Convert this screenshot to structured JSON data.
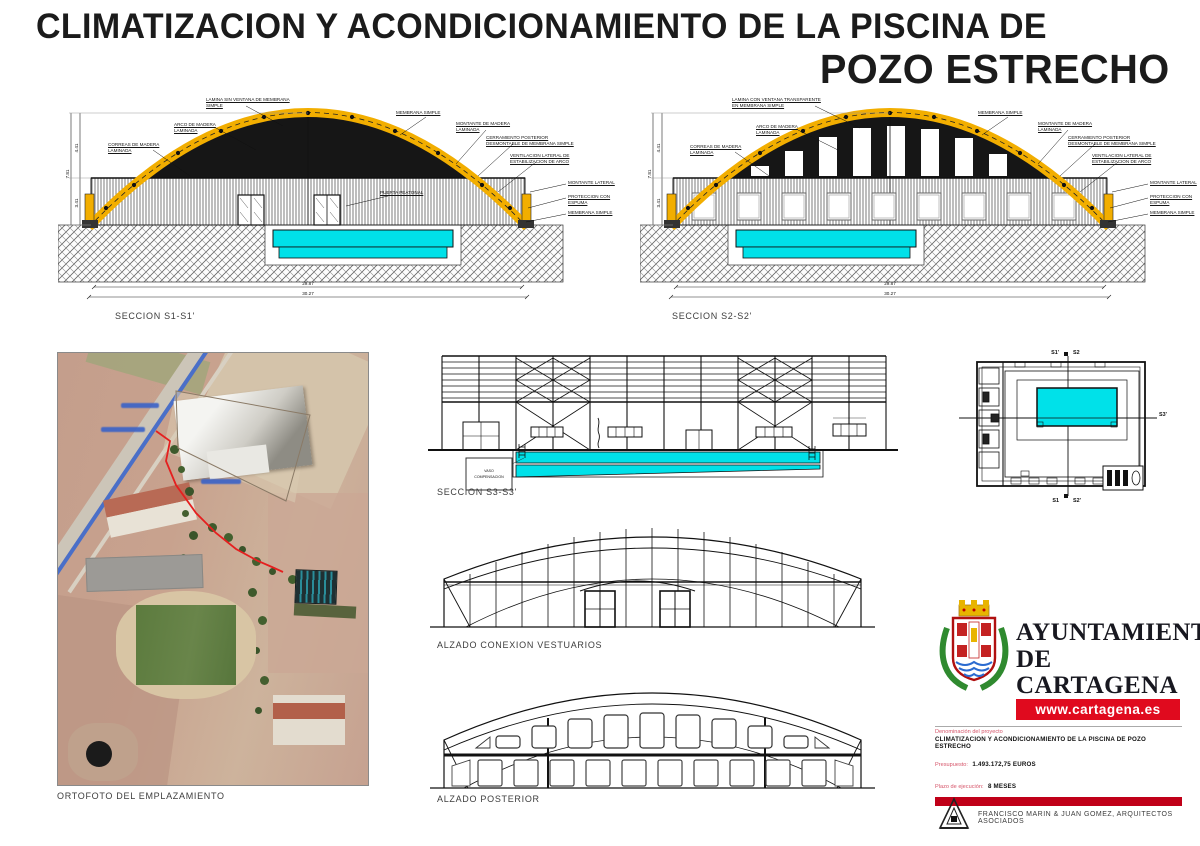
{
  "page": {
    "title_line1": "CLIMATIZACION Y ACONDICIONAMIENTO DE LA PISCINA DE",
    "title_line2": "POZO ESTRECHO"
  },
  "captions": {
    "s1": "SECCION S1-S1'",
    "s2": "SECCION S2-S2'",
    "s3": "SECCION S3-S3'",
    "alzado_vestuarios": "ALZADO CONEXION VESTUARIOS",
    "alzado_posterior": "ALZADO POSTERIOR",
    "ortofoto": "ORTOFOTO DEL EMPLAZAMIENTO"
  },
  "callouts": {
    "lamina_sin": "LAMINA SIN VENTANA DE MEMBRANA SIMPLE",
    "lamina_con": "LAMINA CON VENTANA TRANSPARENTE EN MEMBRANA SIMPLE",
    "arco": "ARCO DE MADERA LAMINADA",
    "correas": "CORREAS DE MADERA LAMINADA",
    "membrana_simple": "MEMBRANA SIMPLE",
    "montante_madera": "MONTANTE DE MADERA LAMINADA",
    "cerramiento": "CERRAMIENTO POSTERIOR DESMONTABLE DE MEMBRANA SIMPLE",
    "ventilacion": "VENTILACION LATERAL DE ESTABILIZACION DE ARCO",
    "montante_lateral": "MONTANTE LATERAL",
    "proteccion": "PROTECCION CON ESPUMA",
    "puerta": "PUERTA PEATONAL"
  },
  "dims": {
    "span_inner": "29.87",
    "span_outer": "30.27",
    "height_total": "7.81",
    "height_upper": "4.41",
    "height_lower": "3.41"
  },
  "plan": {
    "top_a": "S1'",
    "top_b": "S2",
    "right": "S3'",
    "bottom_a": "S1",
    "bottom_b": "S2'"
  },
  "s3": {
    "tank_line1": "VASO",
    "tank_line2": "COMPENSACION"
  },
  "branding": {
    "org_line1": "AYUNTAMIENTO",
    "org_line2": "DE CARTAGENA",
    "website": "www.cartagena.es"
  },
  "project": {
    "denominacion_label": "Denominación del proyecto",
    "denominacion_value": "CLIMATIZACION Y ACONDICIONAMIENTO DE LA PISCINA DE POZO ESTRECHO",
    "presupuesto_label": "Presupuesto:",
    "presupuesto_value": "1.493.172,75 EUROS",
    "plazo_label": "Plazo de ejecución:",
    "plazo_value": "8 MESES"
  },
  "credits": {
    "architects": "FRANCISCO MARIN & JUAN GOMEZ, ARQUITECTOS ASOCIADOS"
  },
  "colors": {
    "accent_red": "#da0a1c",
    "arch_yellow": "#f2ae00",
    "pool_cyan": "#00e1e9",
    "wreath_green": "#2f8a2f"
  }
}
